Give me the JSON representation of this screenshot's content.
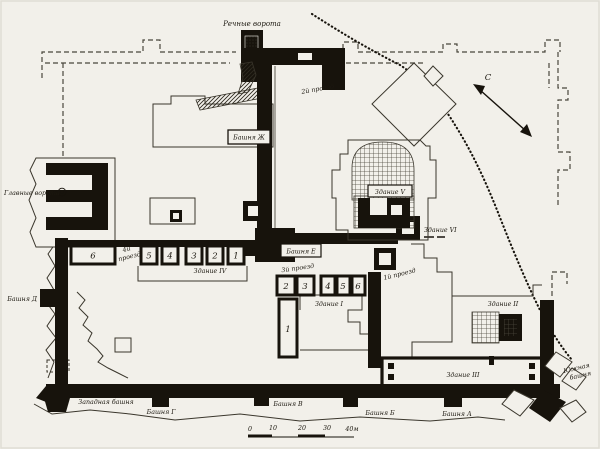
{
  "title": "Fortress excavation plan",
  "colors": {
    "paper": "#f2f0ea",
    "ink": "#17130c",
    "thin_line": "#3a362c",
    "dashed_line": "#4a463c"
  },
  "gates": {
    "river_gate": "Речные ворота",
    "main_gate": "Главные ворота"
  },
  "passages": {
    "p1": "1й проезд",
    "p2": "2й проезд",
    "p3": "3й проезд",
    "p4_line1": "4й",
    "p4_line2": "проезд"
  },
  "towers": {
    "a": "Башня А",
    "b": "Башня Б",
    "v": "Башня В",
    "g": "Башня Г",
    "d": "Башня Д",
    "e": "Башня Е",
    "zh": "Башня Ж",
    "west": "Западная башня",
    "south_line1": "Южная",
    "south_line2": "башня"
  },
  "buildings": {
    "b1": "Здание I",
    "b2": "Здание II",
    "b3": "Здание III",
    "b4": "Здание IV",
    "b5": "Здание V",
    "b6": "Здание VI"
  },
  "rooms": {
    "rowA": [
      "6",
      "5",
      "4",
      "3",
      "2",
      "1"
    ],
    "rowB_left": [
      "2",
      "3"
    ],
    "rowB_right": [
      "4",
      "5",
      "6"
    ],
    "room1": "1"
  },
  "compass": {
    "north": "С"
  },
  "scale_bar": {
    "ticks": [
      "0",
      "10",
      "20",
      "30",
      "40м"
    ]
  }
}
